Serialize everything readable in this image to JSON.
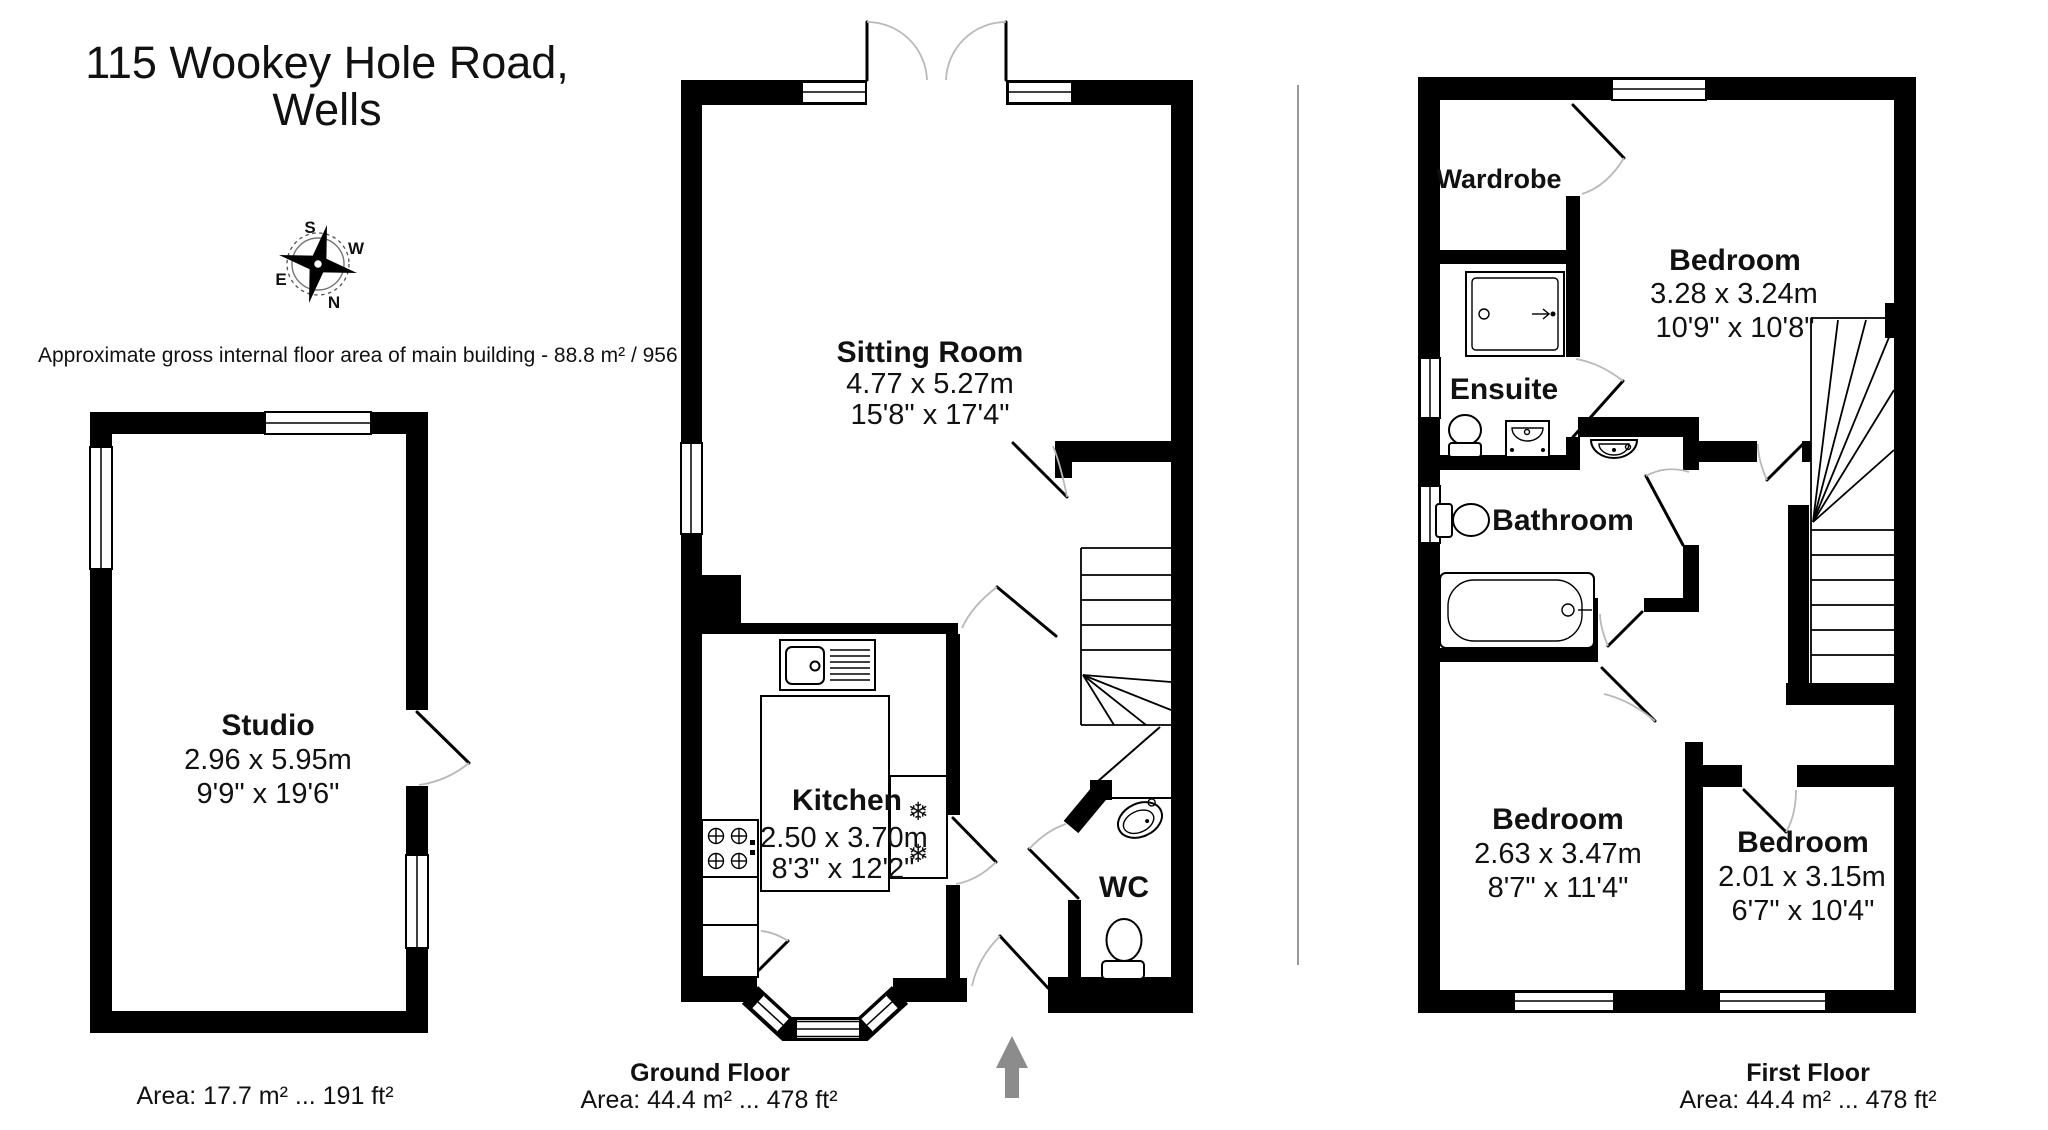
{
  "page": {
    "title_line1": "115 Wookey Hole Road,",
    "title_line2": "Wells",
    "area_note": "Approximate gross internal floor area of main building  -  88.8 m² /  956 ft²"
  },
  "compass": {
    "n": "N",
    "s": "S",
    "e": "E",
    "w": "W"
  },
  "icons": {
    "snowflake": "❄"
  },
  "floors": {
    "studio": {
      "room": {
        "name": "Studio",
        "metric": "2.96 x 5.95m",
        "imperial": "9'9\" x 19'6\""
      },
      "area_label": "Area: 17.7 m² ... 191 ft²"
    },
    "ground": {
      "name": "Ground Floor",
      "area_label": "Area: 44.4 m² ... 478 ft²",
      "rooms": {
        "sitting": {
          "name": "Sitting Room",
          "metric": "4.77 x 5.27m",
          "imperial": "15'8\" x 17'4\""
        },
        "kitchen": {
          "name": "Kitchen",
          "metric": "2.50 x 3.70m",
          "imperial": "8'3\" x 12'2\""
        },
        "wc": {
          "name": "WC"
        }
      }
    },
    "first": {
      "name": "First Floor",
      "area_label": "Area: 44.4 m² ... 478 ft²",
      "rooms": {
        "wardrobe": {
          "name": "Wardrobe"
        },
        "bedroom1": {
          "name": "Bedroom",
          "metric": "3.28 x 3.24m",
          "imperial": "10'9\" x 10'8\""
        },
        "ensuite": {
          "name": "Ensuite"
        },
        "bathroom": {
          "name": "Bathroom"
        },
        "bedroom2": {
          "name": "Bedroom",
          "metric": "2.63 x 3.47m",
          "imperial": "8'7\" x 11'4\""
        },
        "bedroom3": {
          "name": "Bedroom",
          "metric": "2.01 x 3.15m",
          "imperial": "6'7\" x 10'4\""
        }
      }
    }
  }
}
